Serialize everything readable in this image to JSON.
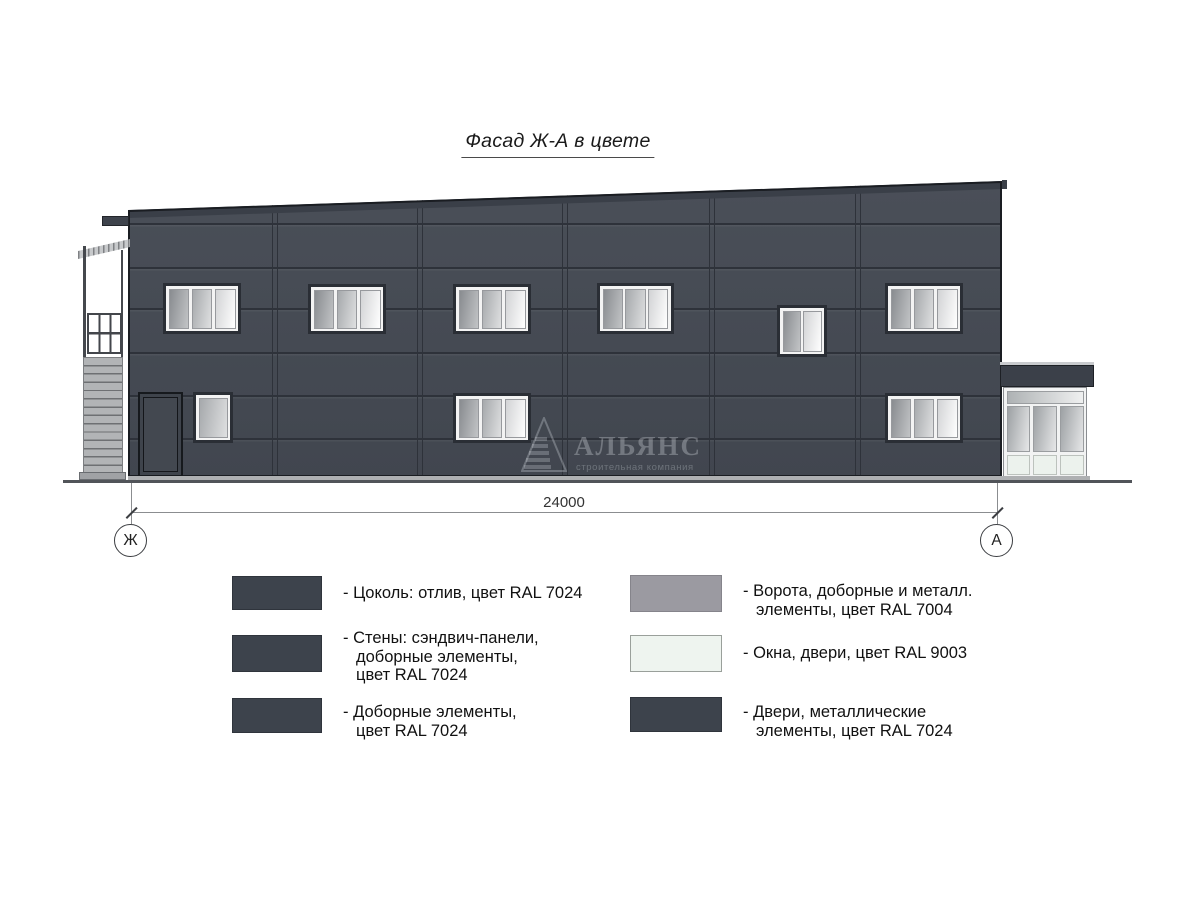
{
  "drawing": {
    "title": "Фасад Ж-А в цвете",
    "dimension_label": "24000",
    "axis_marker_left": "Ж",
    "axis_marker_right": "А"
  },
  "watermark": {
    "company": "АЛЬЯНС",
    "tagline": "строительная компания"
  },
  "legend": {
    "items": [
      {
        "id": "plinth",
        "swatch": "#3d434c",
        "border": "#2f343c",
        "text": "- Цоколь: отлив, цвет RAL 7024"
      },
      {
        "id": "walls",
        "swatch": "#3d434c",
        "border": "#2f343c",
        "text": "- Стены: сэндвич-панели,\nдоборные элементы,\nцвет RAL 7024"
      },
      {
        "id": "trim-elements",
        "swatch": "#3d434c",
        "border": "#2f343c",
        "text": "- Доборные элементы,\nцвет RAL 7024"
      },
      {
        "id": "gates",
        "swatch": "#9b9aa1",
        "border": "#85848b",
        "text": "- Ворота, доборные и металл.\nэлементы, цвет RAL 7004"
      },
      {
        "id": "windows-doors",
        "swatch": "#eef4ef",
        "border": "#9aa09b",
        "text": "- Окна, двери, цвет RAL 9003"
      },
      {
        "id": "metal-doors",
        "swatch": "#3d434c",
        "border": "#2f343c",
        "text": "- Двери, металлические\nэлементы, цвет RAL 7024"
      }
    ]
  },
  "colors": {
    "facade": "#474c55",
    "seam": "#2e323a",
    "window_frame": "#f3f3f3",
    "metal_gray": "#aeb0b2",
    "glass_white": "#ecf2ed"
  }
}
